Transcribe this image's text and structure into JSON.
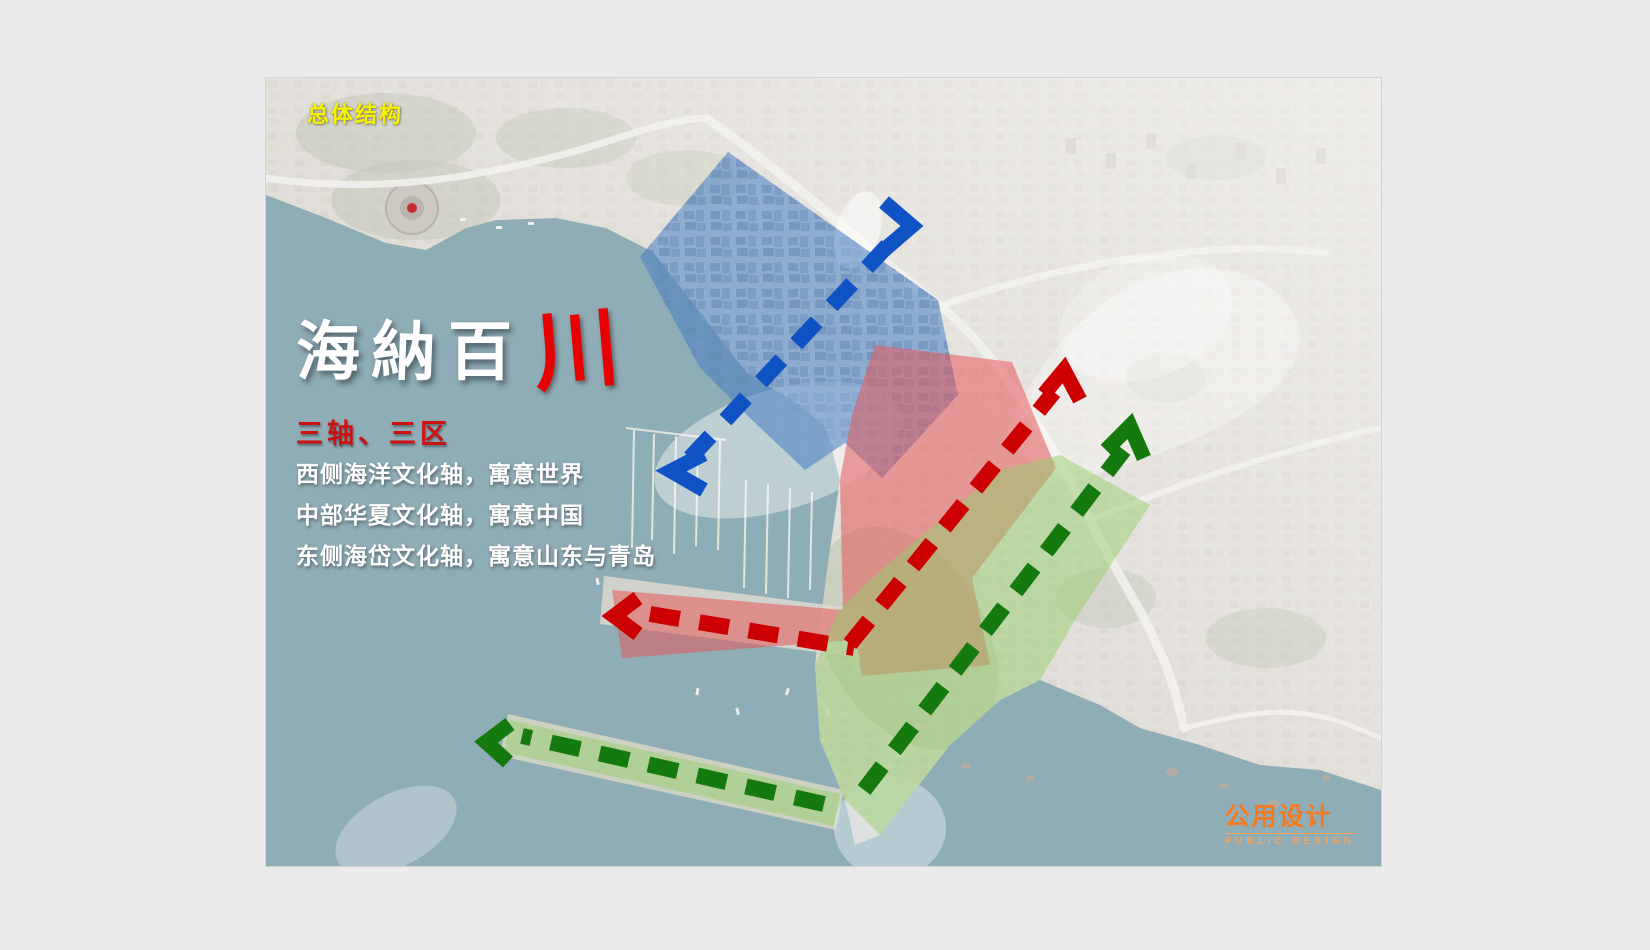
{
  "slide": {
    "section_label": "总体结构",
    "title_calligraphy": {
      "white_chars": [
        "海",
        "納",
        "百"
      ],
      "red_char": "川"
    },
    "subtitle": "三轴、三区",
    "description_lines": [
      "西侧海洋文化轴，寓意世界",
      "中部华夏文化轴，寓意中国",
      "东侧海岱文化轴，寓意山东与青岛"
    ],
    "logo": {
      "cn": "公用设计",
      "en": "PUBLIC DESIGN"
    }
  },
  "map": {
    "zones": [
      {
        "id": "west-marine-culture-axis",
        "color_key": "zone_blue"
      },
      {
        "id": "central-huaxia-culture-axis",
        "color_key": "zone_red"
      },
      {
        "id": "east-haidai-culture-axis",
        "color_key": "zone_green"
      }
    ],
    "arrows": [
      {
        "id": "blue-axis-arrow",
        "style": "dashed, chevron both ends"
      },
      {
        "id": "red-axis-arrow",
        "style": "dashed, chevron both ends, L-shaped"
      },
      {
        "id": "green-axis-arrow",
        "style": "dashed, chevron both ends, two segments"
      }
    ]
  },
  "colors": {
    "background": "#ebebeb",
    "water": "#8fadb6",
    "land": "#d8d4cd",
    "zone_blue": "rgba(70,125,195,0.55)",
    "zone_red": "rgba(228,90,90,0.55)",
    "zone_green": "rgba(150,205,110,0.5)",
    "arrow_blue": "#0f52c4",
    "arrow_red": "#cc0000",
    "arrow_green": "#157a0e",
    "section_label": "#f5f500",
    "subtitle_red": "#cc1111",
    "calligraphy_red": "#e60000",
    "logo_orange": "#f47a20",
    "logo_orange_light": "#f5a25c"
  }
}
